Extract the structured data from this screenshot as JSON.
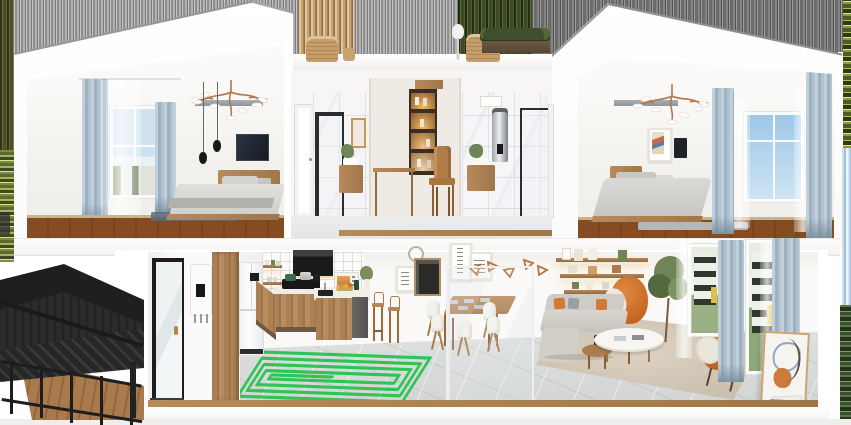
{
  "meta": {
    "title": "3D cutaway render of a two-storey home interior",
    "view": "dollhouse cross-section",
    "canvas": {
      "width": 851,
      "height": 425
    }
  },
  "palette": {
    "wall_white": "#f6f5f3",
    "wood": "#ad8054",
    "wood_floor": "#b5895c",
    "tile_floor": "#d8dad9",
    "curtain_blue": "#a9bcc9",
    "accent_orange": "#cd6f2e",
    "sofa_gray": "#cfccc6",
    "heating_coil_green": "#1fc24b",
    "structure_black": "#262626",
    "marble_white": "#f5f5f7",
    "backsplash_grid": "#dddddc"
  },
  "upper_floor": {
    "left_bedroom": {
      "label": "bedroom",
      "objects": [
        "window with street view",
        "blue-gray curtains",
        "sheer curtain",
        "branch chandelier",
        "two pendant lamps",
        "wall ledge",
        "wall tv",
        "wood bed with gray bedding",
        "blue rug",
        "wood floor"
      ]
    },
    "middle_suite": {
      "label": "bathrooms and hallway nook",
      "objects": [
        "white door left",
        "marble shower with black grid glass",
        "wood vanity with basin",
        "gold framed art",
        "wardrobe with lit display niche",
        "wood desk",
        "wood chair",
        "chrome water heater cylinder",
        "right marble bathroom vanity",
        "glass shower right",
        "white door right",
        "marble floor"
      ]
    },
    "right_bedroom": {
      "label": "bedroom",
      "objects": [
        "branch chandelier",
        "poster art frame",
        "dark wall panel",
        "wall ledge",
        "wood bed with gray bedding",
        "window with sky",
        "blue-gray curtains",
        "sheers",
        "gray rug",
        "wood floor"
      ]
    },
    "roof_terrace": {
      "label": "roof terrace",
      "objects": [
        "wicker chair left",
        "side stool",
        "white table lamp",
        "wicker chair right",
        "hedge planter box"
      ]
    }
  },
  "ground_floor": {
    "entry": {
      "label": "entry",
      "objects": [
        "black framed glass door",
        "brass handle",
        "wall boiler with black display",
        "tall wood cabinet column"
      ]
    },
    "kitchen": {
      "label": "kitchen",
      "objects": [
        "white french-door fridge",
        "grid tile backsplash",
        "black range hood",
        "open wood shelves",
        "gas cooktop with pots",
        "terrazzo counters",
        "wood base cabinets",
        "island with sink and cutting board",
        "microwave oven",
        "two wood bar stools"
      ],
      "floor_overlay": {
        "name": "underfloor heating coil",
        "shape": "rectangular spiral",
        "loops": 5,
        "color": "#1fc24b"
      }
    },
    "dining": {
      "label": "dining area",
      "objects": [
        "wall clock",
        "four framed posters",
        "hanging triangle ornaments",
        "wood dining table with placemats",
        "five white shell chairs",
        "glass partition with black marble base"
      ]
    },
    "living": {
      "label": "living room",
      "objects": [
        "three floating wood shelves with warm lighting",
        "decor vases and frames",
        "tall ficus plant",
        "orange egg chair with white throw",
        "gray fabric sofa with orange cushions",
        "white oval coffee table",
        "round wood side table",
        "orange armchair with cream throw",
        "beige area rug",
        "two windows with townhouse view",
        "blue-gray curtains",
        "leaning abstract art canvas",
        "stack of books"
      ]
    }
  },
  "exterior": {
    "left_structure": {
      "label": "black metal stair structure",
      "objects": [
        "black slanted canopy",
        "lattice panels",
        "railing posts and rails",
        "wood deck"
      ]
    },
    "edge_smears": [
      "olive tree smear left",
      "foliage speckle left",
      "gray sky streaks top",
      "hedge smear above terrace",
      "foliage speckle right",
      "blue smear right",
      "green foliage right"
    ]
  }
}
